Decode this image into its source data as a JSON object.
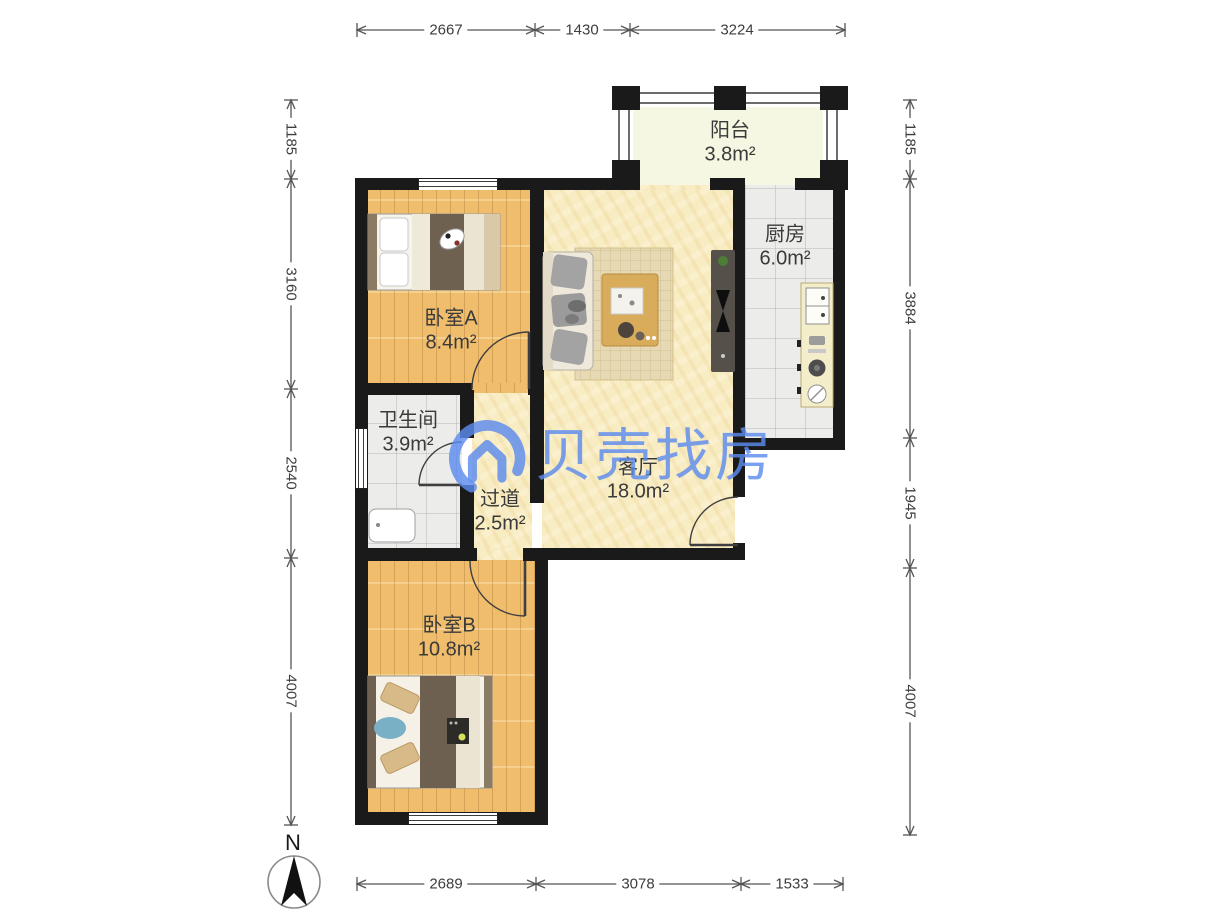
{
  "watermark": {
    "text": "贝壳找房"
  },
  "compass": {
    "label": "N"
  },
  "rooms": {
    "balcony": {
      "name": "阳台",
      "area": "3.8m²"
    },
    "kitchen": {
      "name": "厨房",
      "area": "6.0m²"
    },
    "bedroomA": {
      "name": "卧室A",
      "area": "8.4m²"
    },
    "bathroom": {
      "name": "卫生间",
      "area": "3.9m²"
    },
    "hallway": {
      "name": "过道",
      "area": "2.5m²"
    },
    "living": {
      "name": "客厅",
      "area": "18.0m²"
    },
    "bedroomB": {
      "name": "卧室B",
      "area": "10.8m²"
    }
  },
  "dimensions": {
    "top": [
      "2667",
      "1430",
      "3224"
    ],
    "bottom": [
      "2689",
      "3078",
      "1533"
    ],
    "left": [
      "1185",
      "3160",
      "2540",
      "4007"
    ],
    "right": [
      "1185",
      "3884",
      "1945",
      "4007"
    ]
  }
}
